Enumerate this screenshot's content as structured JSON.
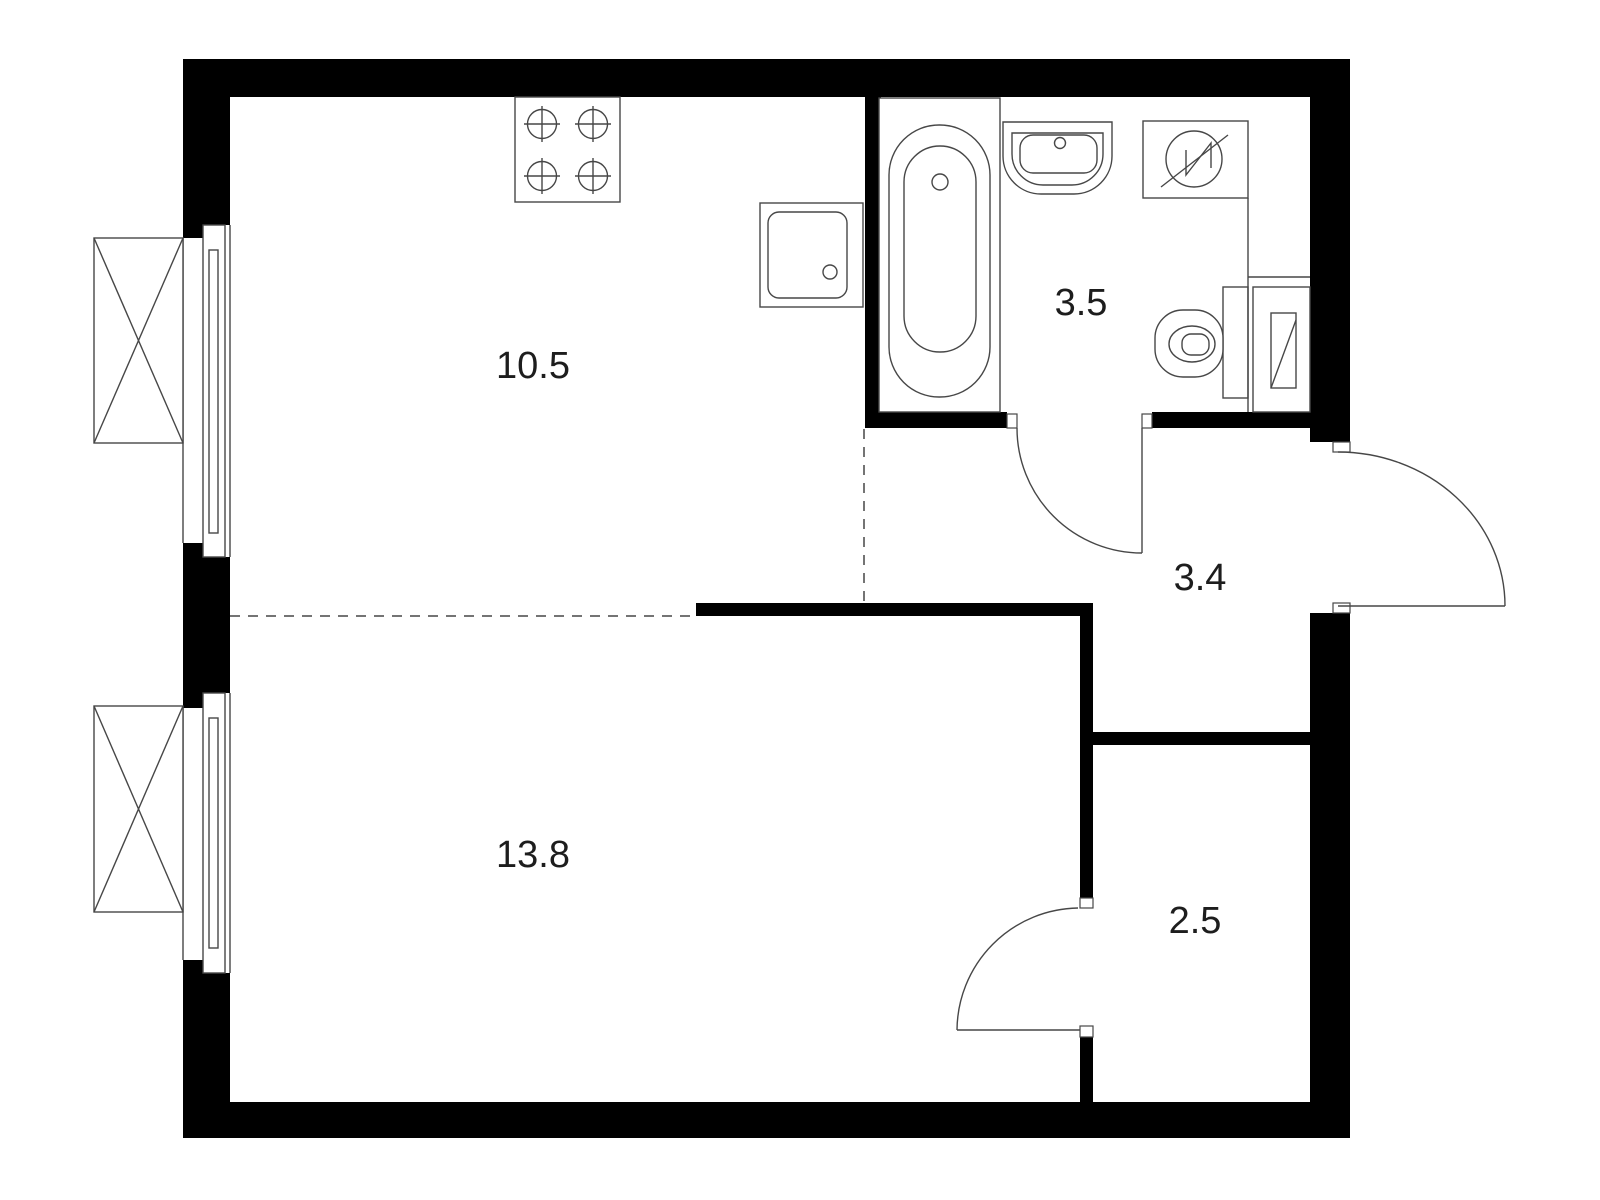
{
  "document": {
    "type": "apartment-floor-plan",
    "units": "square-meters"
  },
  "rooms": [
    {
      "name": "kitchen",
      "area": "10.5"
    },
    {
      "name": "bathroom",
      "area": "3.5"
    },
    {
      "name": "hallway",
      "area": "3.4"
    },
    {
      "name": "living-room",
      "area": "13.8"
    },
    {
      "name": "storage",
      "area": "2.5"
    }
  ],
  "fixtures": [
    {
      "icon": "stove-icon",
      "room": "kitchen"
    },
    {
      "icon": "kitchen-sink-icon",
      "room": "kitchen"
    },
    {
      "icon": "bathtub-icon",
      "room": "bathroom"
    },
    {
      "icon": "washbasin-icon",
      "room": "bathroom"
    },
    {
      "icon": "washing-machine-icon",
      "room": "bathroom"
    },
    {
      "icon": "toilet-icon",
      "room": "bathroom"
    },
    {
      "icon": "water-heater-icon",
      "room": "bathroom"
    },
    {
      "icon": "window-icon",
      "room": "kitchen"
    },
    {
      "icon": "window-icon",
      "room": "living-room"
    },
    {
      "icon": "door-swing-icon",
      "room": "bathroom"
    },
    {
      "icon": "door-swing-icon",
      "room": "hallway"
    },
    {
      "icon": "door-swing-icon",
      "room": "storage"
    }
  ],
  "colors": {
    "wall": "#000000",
    "line": "#474747",
    "background": "#ffffff",
    "label": "#1d1d1d"
  }
}
